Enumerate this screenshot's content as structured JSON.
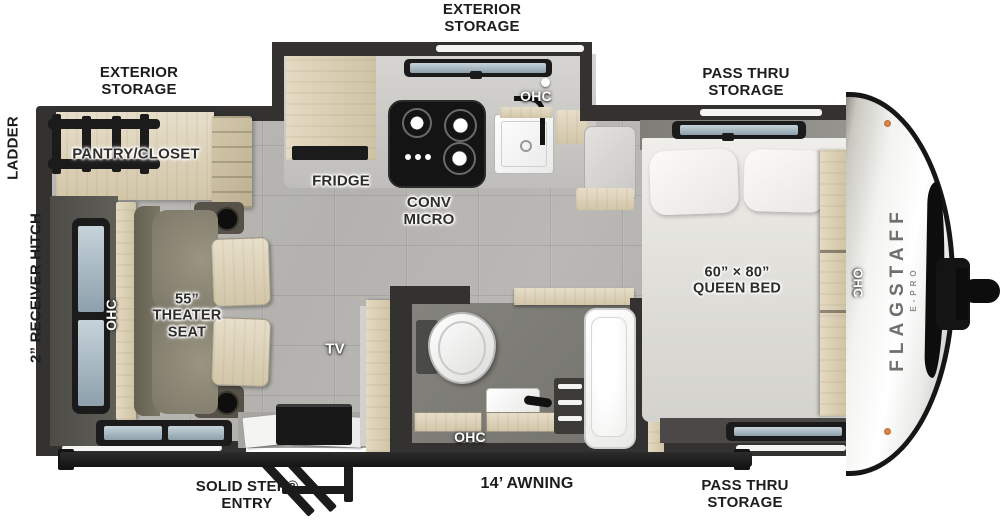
{
  "title": "Travel trailer floor plan",
  "exterior_labels": {
    "rear_storage": "EXTERIOR STORAGE",
    "kitchen_storage": "EXTERIOR STORAGE",
    "front_storage_top": "PASS THRU STORAGE",
    "front_storage_bottom": "PASS THRU STORAGE",
    "ladder": "LADDER",
    "receiver_hitch": "2” RECEIVER HITCH",
    "entry": "SOLID STEP® ENTRY",
    "awning": "14’ AWNING"
  },
  "interior_labels": {
    "pantry": "PANTRY/CLOSET",
    "fridge": "FRIDGE",
    "microwave": "CONV MICRO",
    "bed": "60” × 80” QUEEN BED",
    "theater_seat": "55” THEATER SEAT",
    "tv": "TV",
    "ohc": "OHC"
  },
  "brand": {
    "name": "FLAGSTAFF",
    "series": "E-PRO"
  },
  "colors": {
    "wall": "#333231",
    "cabinet": "#ddd3ba",
    "floor": "#b5b4b0",
    "fixture_black": "#1b1b1b"
  }
}
